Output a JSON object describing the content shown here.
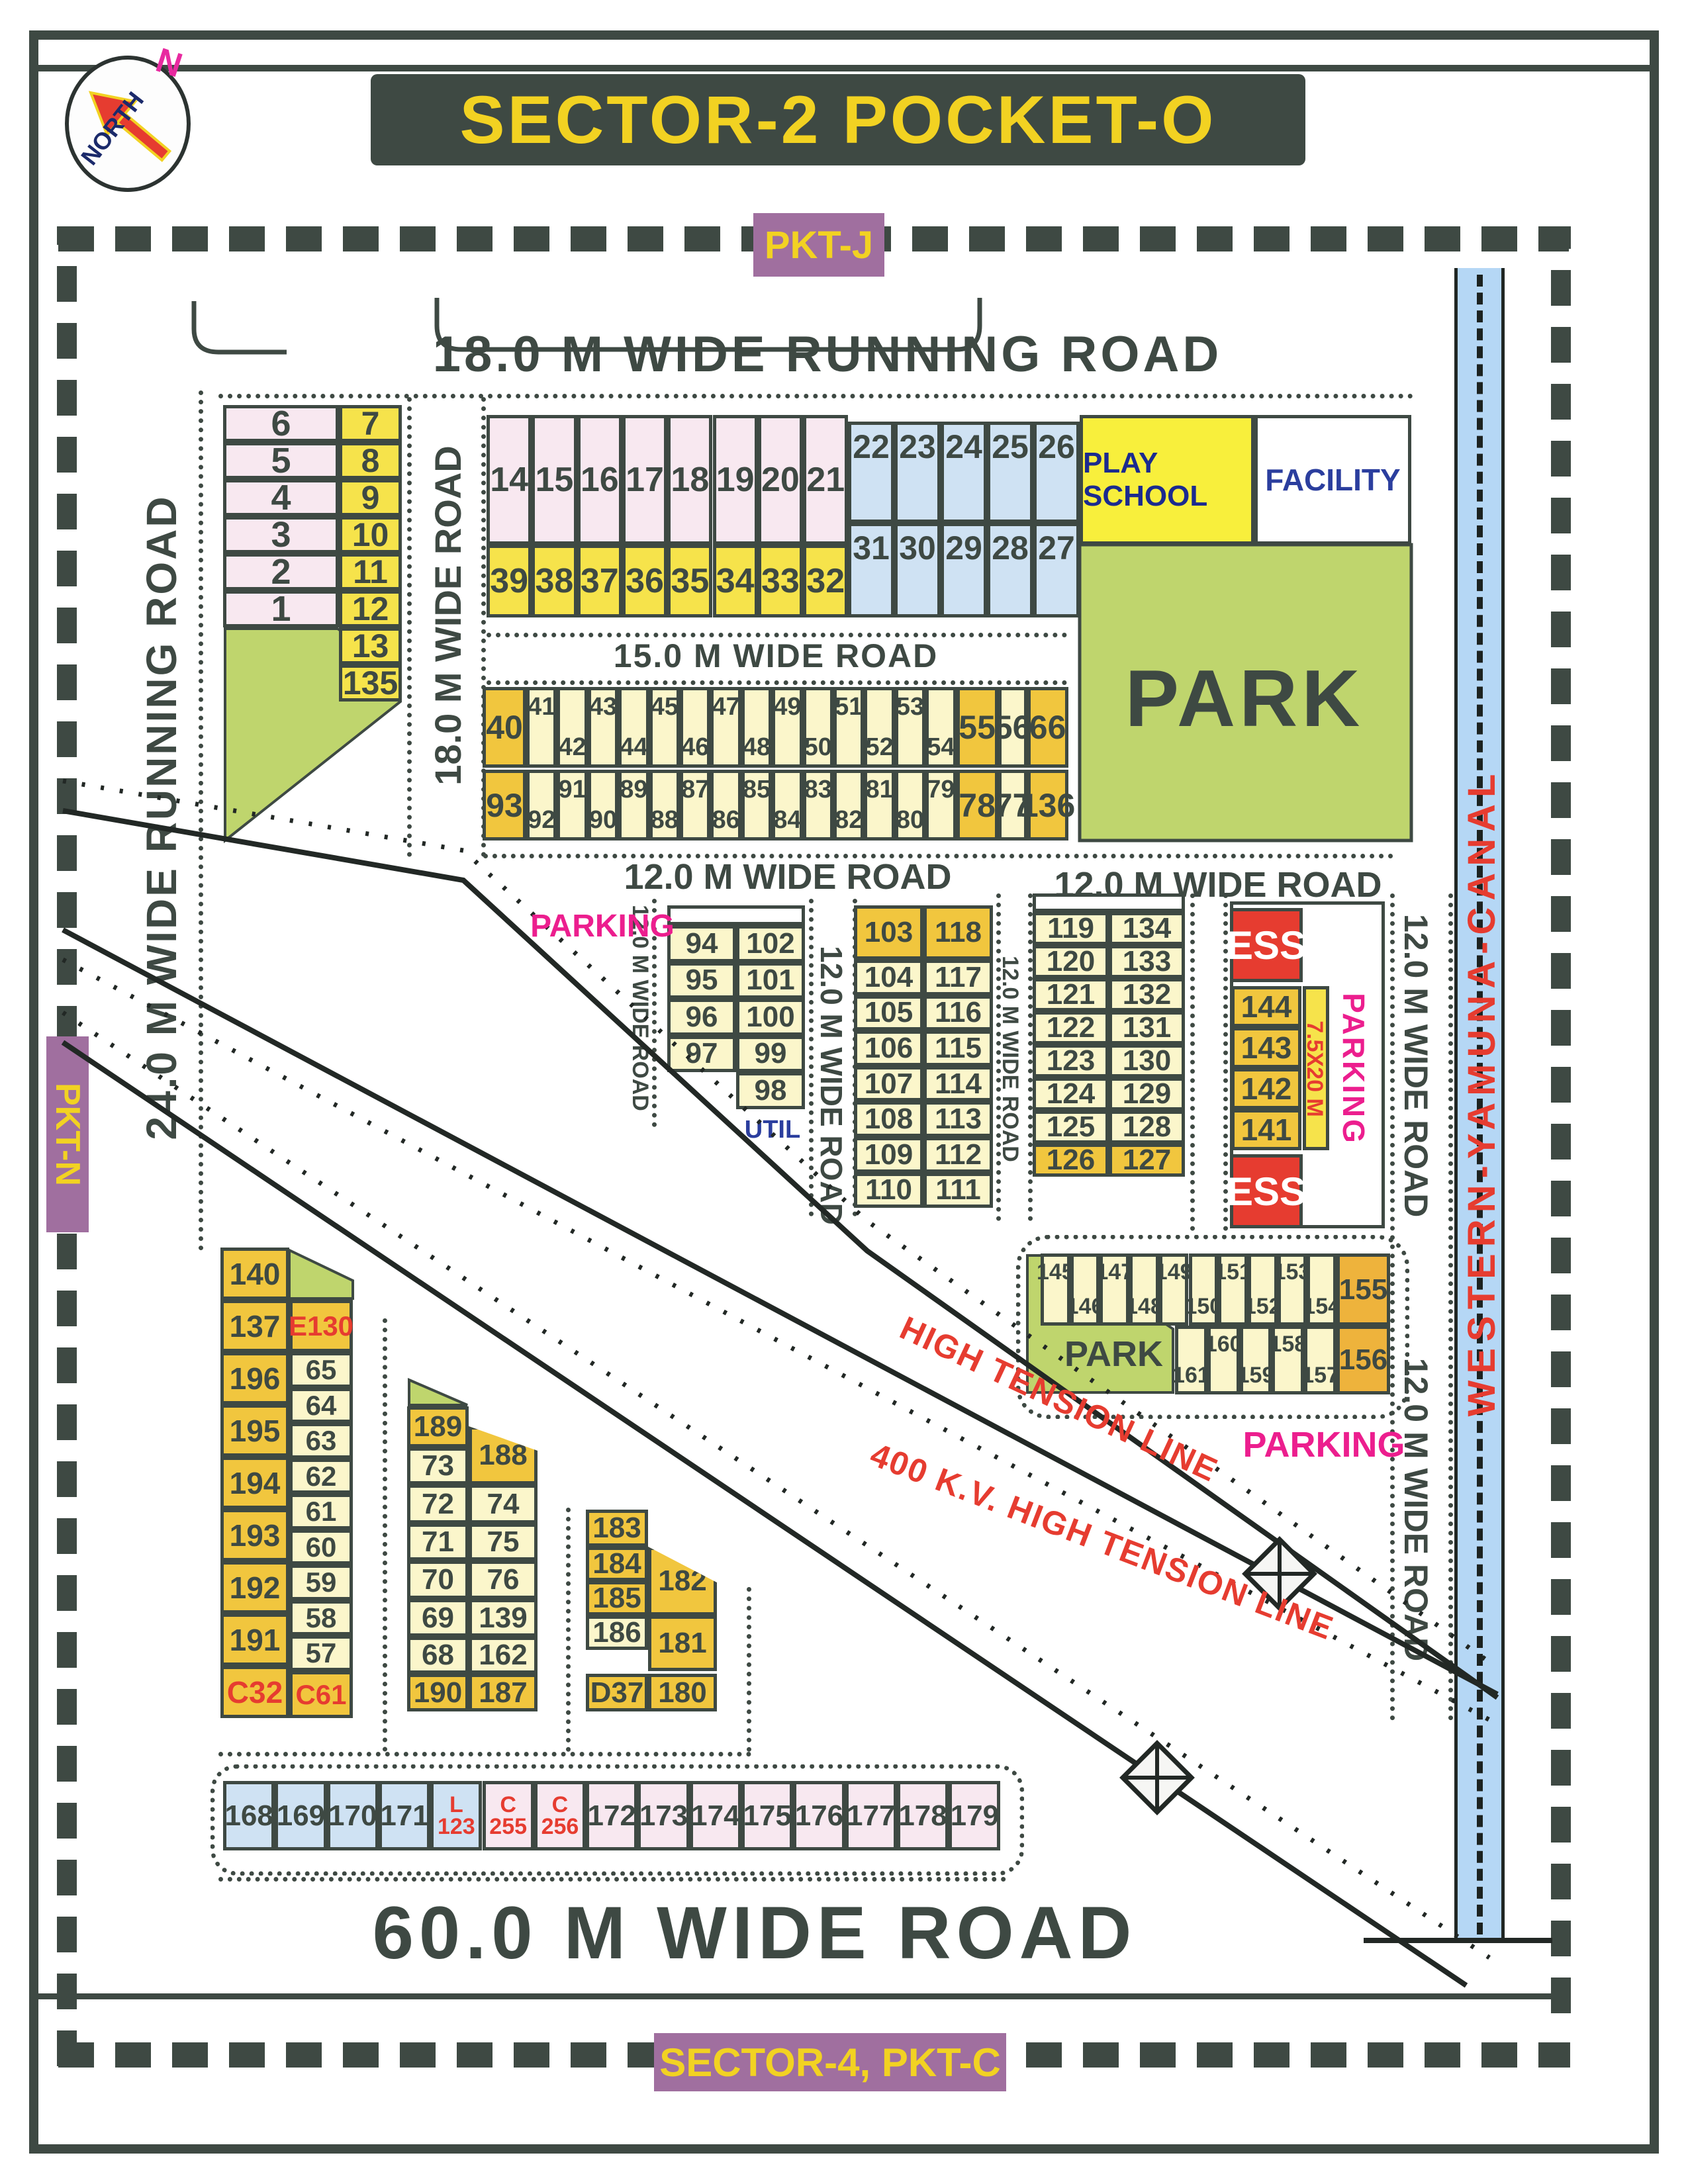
{
  "title": "SECTOR-2 POCKET-O",
  "north": {
    "label": "NORTH",
    "n": "N"
  },
  "edge_labels": {
    "pkt_j": "PKT-J",
    "pkt_n": "PKT-N",
    "sector4": "SECTOR-4, PKT-C"
  },
  "roads": {
    "running18": "18.0 M WIDE RUNNING ROAD",
    "wide18": "18.0 M WIDE ROAD",
    "wide15": "15.0 M WIDE ROAD",
    "wide12": "12.0 M WIDE ROAD",
    "running24": "24.0 M WIDE RUNNING ROAD",
    "wide60": "60.0 M WIDE ROAD",
    "canal": "WESTERN-YAMUNA-CANAL"
  },
  "areas": {
    "park": "PARK",
    "play_school": "PLAY SCHOOL",
    "facility": "FACILITY",
    "parking": "PARKING",
    "util": "UTIL",
    "ess": "ESS",
    "ess_dim": "7.5X20 M",
    "high_tension_1": "HIGH TENSION LINE",
    "high_tension_2": "400 K.V. HIGH TENSION LINE"
  },
  "colors": {
    "ink": "#3e4943",
    "pink": "#f8e8f0",
    "yellow": "#f6e34b",
    "pale_yellow": "#fbf6cb",
    "dark_yellow": "#f1c63e",
    "orange_yellow": "#eeb33c",
    "blue": "#cfe2f3",
    "green": "#bfd56d",
    "play_yellow": "#f8ef3c",
    "red": "#e63c30",
    "magenta": "#ec1e8e",
    "purple": "#a06f9f",
    "canal_blue": "#b5d7f5",
    "navy": "#2b3e9e"
  },
  "blocks": {
    "nw_pair": {
      "left": [
        "6",
        "5",
        "4",
        "3",
        "2",
        "1"
      ],
      "right": [
        "7",
        "8",
        "9",
        "10",
        "11",
        "12",
        "13",
        "135"
      ]
    },
    "grid14": {
      "top": [
        "14",
        "15",
        "16",
        "17",
        "18",
        "19",
        "20",
        "21"
      ],
      "bottom": [
        "39",
        "38",
        "37",
        "36",
        "35",
        "34",
        "33",
        "32"
      ]
    },
    "grid22": {
      "top": [
        "22",
        "23",
        "24",
        "25",
        "26"
      ],
      "bottom": [
        "31",
        "30",
        "29",
        "28",
        "27"
      ]
    },
    "row40": [
      "40",
      "41",
      "42",
      "43",
      "44",
      "45",
      "46",
      "47",
      "48",
      "49",
      "50",
      "51",
      "52",
      "53",
      "54",
      "55",
      "56",
      "66"
    ],
    "row93": [
      "93",
      "92",
      "91",
      "90",
      "89",
      "88",
      "87",
      "86",
      "85",
      "84",
      "83",
      "82",
      "81",
      "80",
      "79",
      "78",
      "77",
      "136"
    ],
    "b94": [
      [
        "94",
        "102"
      ],
      [
        "95",
        "101"
      ],
      [
        "96",
        "100"
      ],
      [
        "97",
        "99"
      ],
      [
        null,
        "98"
      ]
    ],
    "b103": [
      [
        "103",
        "118"
      ],
      [
        "104",
        "117"
      ],
      [
        "105",
        "116"
      ],
      [
        "106",
        "115"
      ],
      [
        "107",
        "114"
      ],
      [
        "108",
        "113"
      ],
      [
        "109",
        "112"
      ],
      [
        "110",
        "111"
      ]
    ],
    "b119": [
      [
        "119",
        "134"
      ],
      [
        "120",
        "133"
      ],
      [
        "121",
        "132"
      ],
      [
        "122",
        "131"
      ],
      [
        "123",
        "130"
      ],
      [
        "124",
        "129"
      ],
      [
        "125",
        "128"
      ],
      [
        "126",
        "127"
      ]
    ],
    "ess_cells": [
      "144",
      "143",
      "142",
      "141"
    ],
    "strip145": {
      "top": [
        "145",
        "146",
        "147",
        "148",
        "149",
        "150",
        "151",
        "152",
        "153",
        "154",
        "155"
      ],
      "bottom": [
        "161",
        "160",
        "159",
        "158",
        "157",
        "156"
      ]
    },
    "g140": {
      "left": [
        "140",
        "137",
        "196",
        "195",
        "194",
        "193",
        "192",
        "191",
        "C32"
      ],
      "right": [
        "E130",
        "65",
        "64",
        "63",
        "62",
        "61",
        "60",
        "59",
        "58",
        "57",
        "C61"
      ],
      "red_labels": [
        "E130",
        "C32",
        "C61"
      ]
    },
    "g189": {
      "left": [
        "189",
        "73",
        "72",
        "71",
        "70",
        "69",
        "68",
        "190"
      ],
      "right": [
        "188",
        "74",
        "75",
        "76",
        "139",
        "162",
        "187"
      ]
    },
    "g183": {
      "left": [
        "183",
        "184",
        "185",
        "186"
      ],
      "right": [
        "182",
        "181"
      ],
      "bottom": [
        "D37",
        "180"
      ]
    },
    "bottom_row": [
      {
        "t": "168",
        "bg": "blue"
      },
      {
        "t": "169",
        "bg": "blue"
      },
      {
        "t": "170",
        "bg": "blue"
      },
      {
        "t": "171",
        "bg": "blue"
      },
      {
        "t": "L",
        "b": "123",
        "bg": "blue",
        "red": true
      },
      {
        "t": "C",
        "b": "255",
        "bg": "pink",
        "red": true
      },
      {
        "t": "C",
        "b": "256",
        "bg": "pink",
        "red": true
      },
      {
        "t": "172",
        "bg": "pink"
      },
      {
        "t": "173",
        "bg": "pink"
      },
      {
        "t": "174",
        "bg": "pink"
      },
      {
        "t": "175",
        "bg": "pink"
      },
      {
        "t": "176",
        "bg": "pink"
      },
      {
        "t": "177",
        "bg": "pink"
      },
      {
        "t": "178",
        "bg": "pink"
      },
      {
        "t": "179",
        "bg": "pink"
      }
    ]
  }
}
